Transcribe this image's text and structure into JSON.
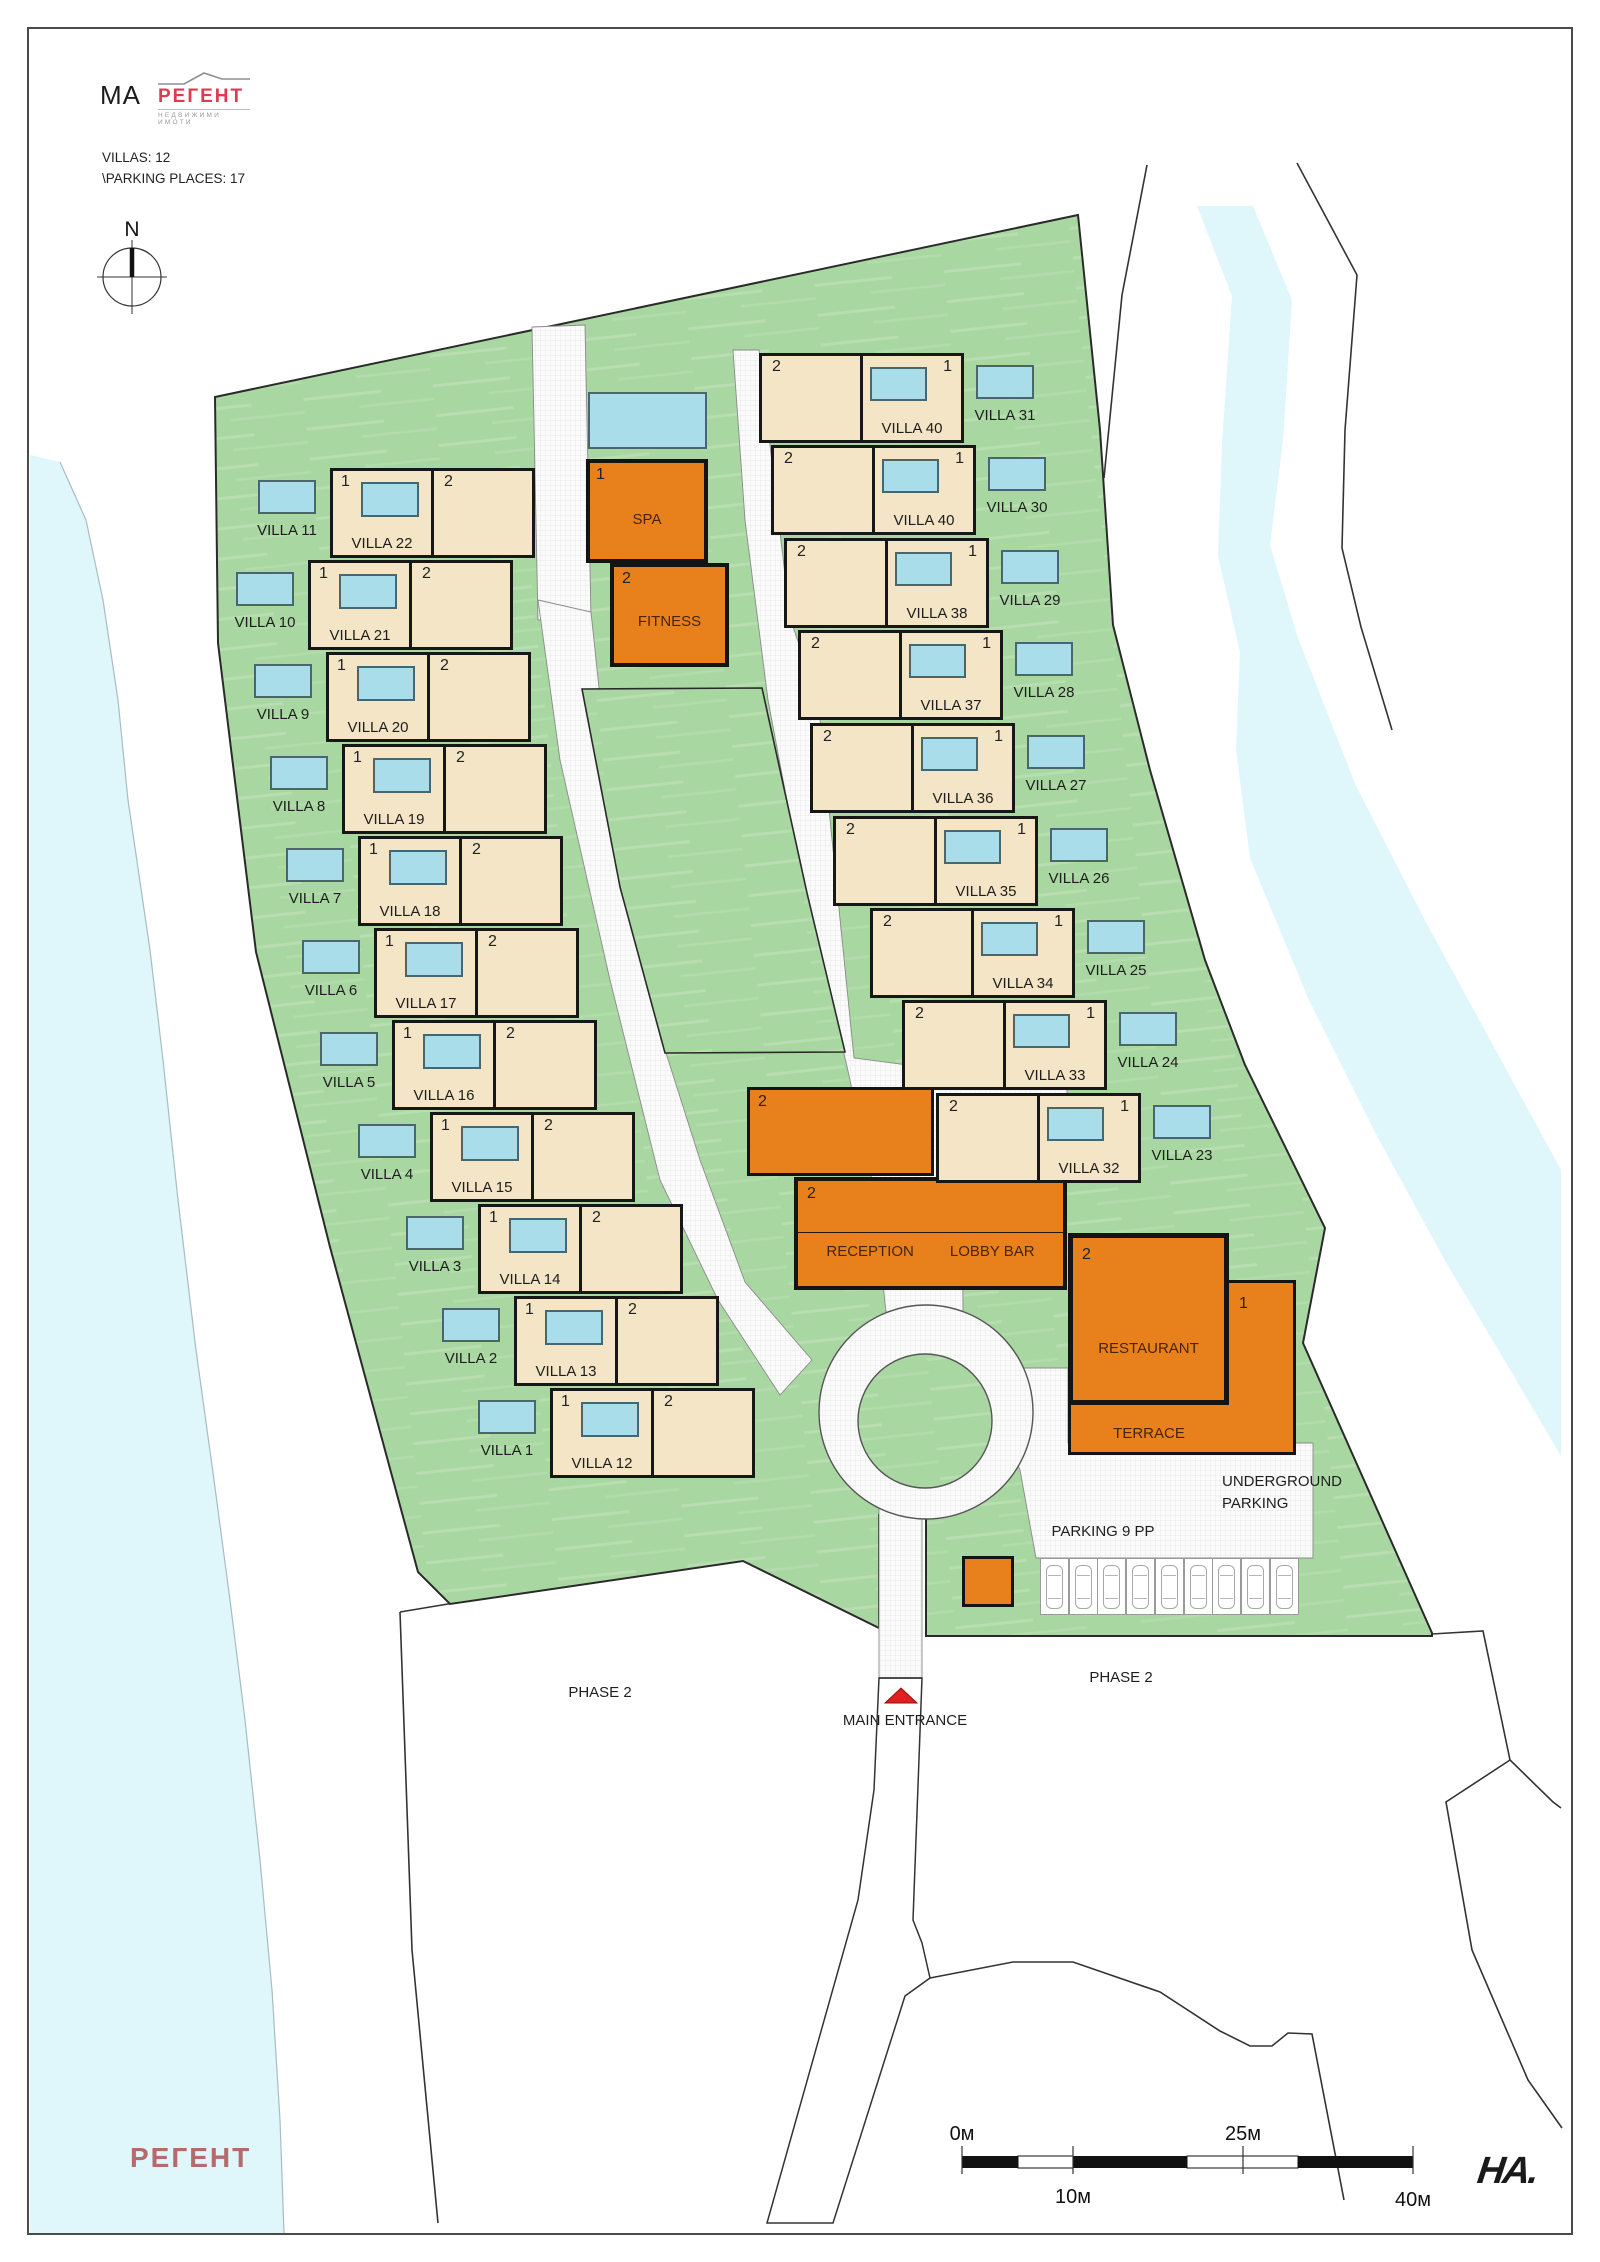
{
  "header": {
    "project_code": "MA",
    "brand": "РЕГЕНТ",
    "brand_caption": "НЕДВИЖИМИ ИМОТИ",
    "villas_line": "VILLAS: 12",
    "parking_line": "\\PARKING PLACES: 17"
  },
  "compass": {
    "label": "N"
  },
  "site": {
    "unit_numbers": {
      "one": "1",
      "two": "2"
    },
    "left_rows": [
      {
        "outside_pool": "VILLA 11",
        "building": "VILLA 22"
      },
      {
        "outside_pool": "VILLA 10",
        "building": "VILLA 21"
      },
      {
        "outside_pool": "VILLA 9",
        "building": "VILLA 20"
      },
      {
        "outside_pool": "VILLA 8",
        "building": "VILLA 19"
      },
      {
        "outside_pool": "VILLA 7",
        "building": "VILLA 18"
      },
      {
        "outside_pool": "VILLA 6",
        "building": "VILLA 17"
      },
      {
        "outside_pool": "VILLA 5",
        "building": "VILLA 16"
      },
      {
        "outside_pool": "VILLA 4",
        "building": "VILLA 15"
      },
      {
        "outside_pool": "VILLA 3",
        "building": "VILLA 14"
      },
      {
        "outside_pool": "VILLA 2",
        "building": "VILLA 13"
      },
      {
        "outside_pool": "VILLA 1",
        "building": "VILLA 12"
      }
    ],
    "right_rows": [
      {
        "building": "VILLA 40",
        "outside_pool": "VILLA 31"
      },
      {
        "building": "VILLA 40",
        "outside_pool": "VILLA 30"
      },
      {
        "building": "VILLA 38",
        "outside_pool": "VILLA 29"
      },
      {
        "building": "VILLA 37",
        "outside_pool": "VILLA 28"
      },
      {
        "building": "VILLA 36",
        "outside_pool": "VILLA 27"
      },
      {
        "building": "VILLA 35",
        "outside_pool": "VILLA 26"
      },
      {
        "building": "VILLA 34",
        "outside_pool": "VILLA 25"
      },
      {
        "building": "VILLA 33",
        "outside_pool": "VILLA 24"
      },
      {
        "building": "VILLA 32",
        "outside_pool": "VILLA 23"
      }
    ],
    "amenities": {
      "spa": "SPA",
      "fitness": "FITNESS",
      "reception": "RECEPTION",
      "lobby_bar": "LOBBY BAR",
      "restaurant": "RESTAURANT",
      "terrace": "TERRACE"
    },
    "underground": {
      "line1": "UNDERGROUND",
      "line2": "PARKING"
    },
    "parking": {
      "label": "PARKING 9 PP",
      "stall_count": 9
    },
    "entrance": {
      "label": "MAIN ENTRANCE"
    },
    "phase2_left": "PHASE 2",
    "phase2_right": "PHASE 2"
  },
  "scale_bar": {
    "zero": "0м",
    "ten": "10м",
    "twentyfive": "25м",
    "forty": "40м"
  },
  "footer": {
    "watermark": "РЕГЕНТ",
    "architect_logo": "HA."
  },
  "colors": {
    "site_green": "#a9d7a1",
    "villa_beige": "#f3e5c5",
    "pool_blue": "#a9dde9",
    "amenity_orange": "#e8811c",
    "water_cyan": "#dff6fb",
    "entrance_red": "#e02020",
    "brand_red": "#e03a4e"
  }
}
